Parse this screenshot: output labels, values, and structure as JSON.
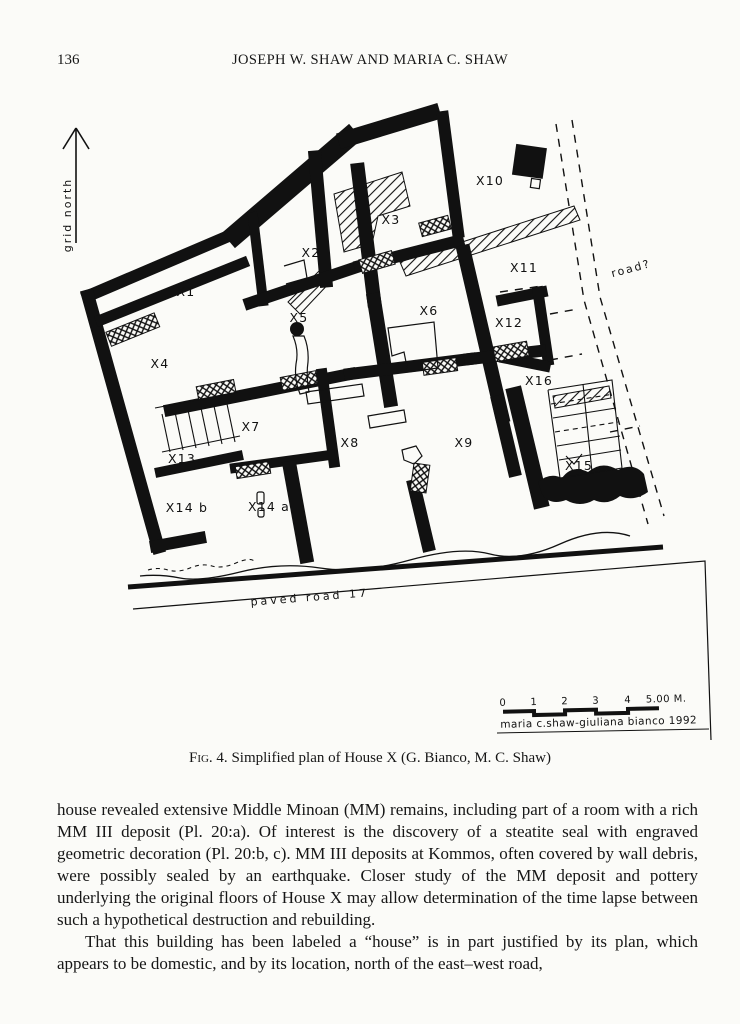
{
  "page": {
    "number": "136",
    "running_header": "JOSEPH W. SHAW AND MARIA C. SHAW"
  },
  "figure": {
    "north_label": "grid north",
    "road_right_label": "road?",
    "road_bottom_label": "paved road 17",
    "rooms": [
      "X1",
      "X2",
      "X3",
      "X4",
      "X5",
      "X6",
      "X7",
      "X8",
      "X9",
      "X10",
      "X11",
      "X12",
      "X13",
      "X14 a",
      "X14 b",
      "X15",
      "X16"
    ],
    "scale": {
      "ticks": [
        "0",
        "1",
        "2",
        "3",
        "4"
      ],
      "end_label": "5.00 M.",
      "credit": "maria c.shaw-giuliana bianco 1992"
    }
  },
  "caption": {
    "label": "Fig. 4.",
    "text": " Simplified plan of House X (G. Bianco, M. C. Shaw)"
  },
  "body": {
    "para1": "house revealed extensive Middle Minoan (MM) remains, including part of a room with a rich MM III deposit (Pl. 20:a).  Of interest is the discovery of a steatite seal with engraved geometric decoration (Pl. 20:b, c). MM III deposits at Kommos, often covered by wall debris, were possibly sealed by an earthquake.  Closer study of the MM deposit and pottery underlying the original floors of House X may allow determination of the time lapse between such a hypothetical destruction and rebuilding.",
    "para2": "That this building has been labeled a “house” is in part justified by its plan, which appears to be domestic, and by its location, north of the east–west road,"
  },
  "colors": {
    "paper": "#fbfbf8",
    "ink": "#111111"
  }
}
